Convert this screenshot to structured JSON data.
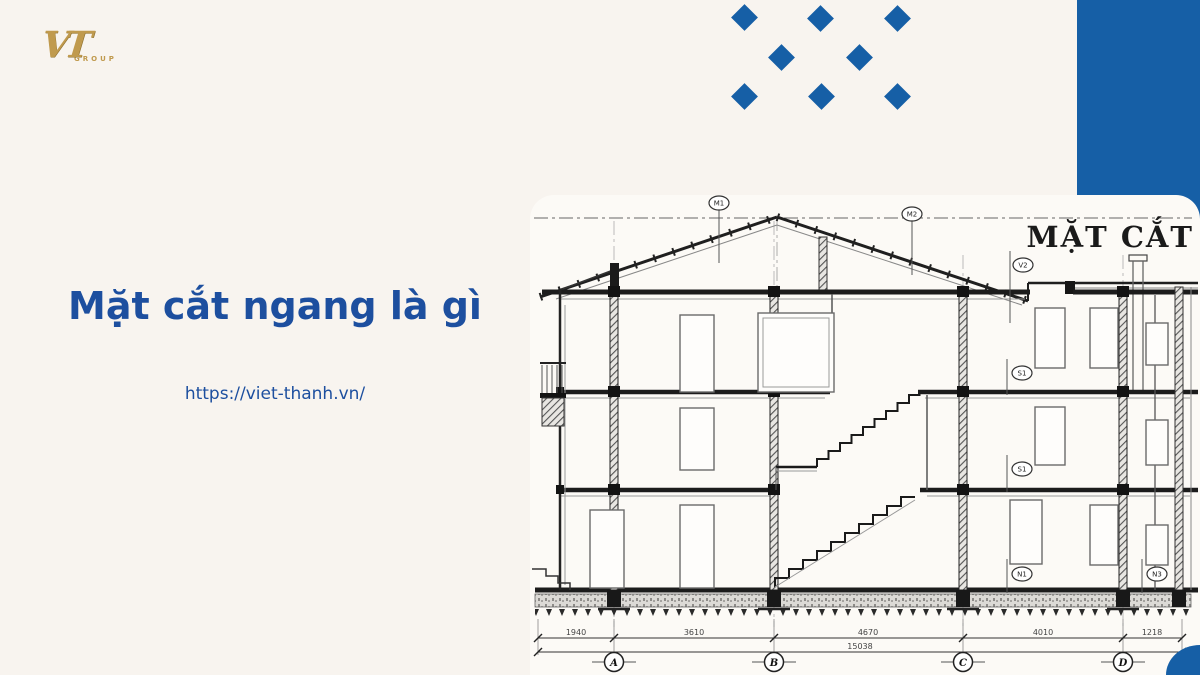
{
  "colors": {
    "background": "#f8f4ef",
    "accent_blue": "#165fa6",
    "text_blue": "#1d4f9f",
    "logo_gold": "#c09a4e",
    "panel": "#fcfaf6"
  },
  "logo": {
    "monogram": "VT",
    "group": "GROUP"
  },
  "hero": {
    "title": "Mặt cắt ngang là gì",
    "url": "https://viet-thanh.vn/"
  },
  "drawing": {
    "title": "MẶT CẮT",
    "grid_labels": [
      "A",
      "B",
      "C",
      "D"
    ],
    "dims": [
      "1940",
      "3610",
      "4670",
      "4010",
      "1218"
    ],
    "total_dim": "15038",
    "callouts": [
      "M1",
      "M2",
      "V2",
      "S1",
      "S1",
      "N1",
      "N3"
    ]
  }
}
